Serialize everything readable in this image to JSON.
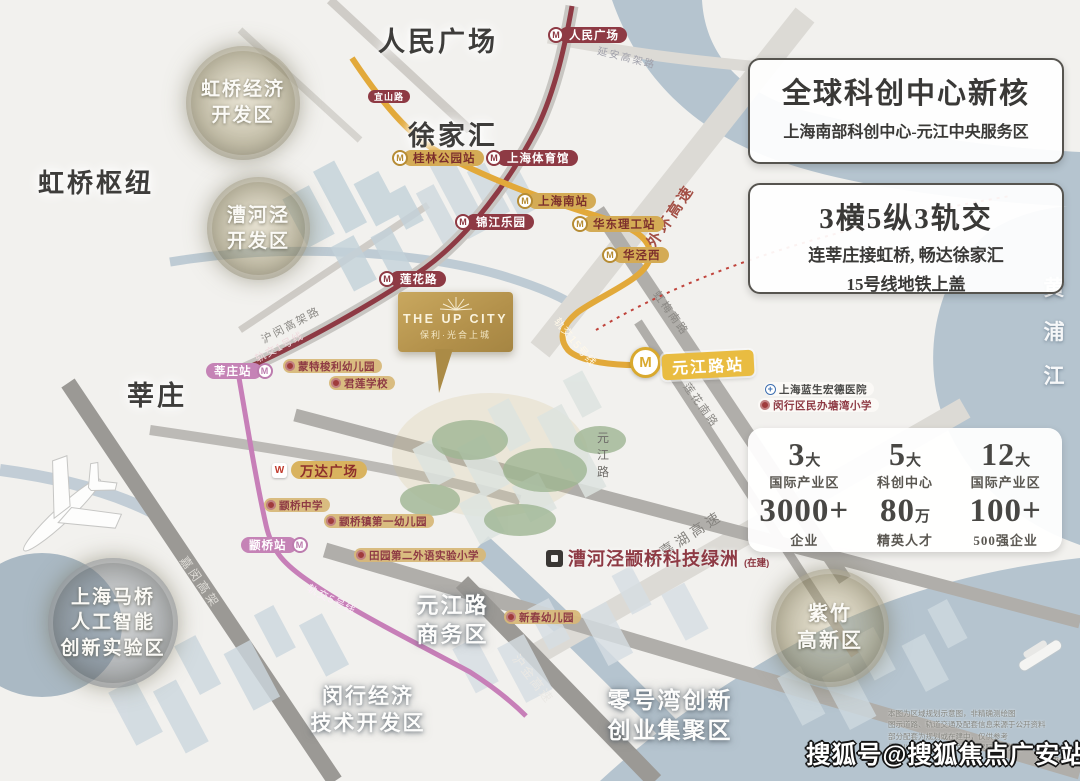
{
  "project": {
    "name_en": "THE UP CITY",
    "name_cn": "保利·光合上城"
  },
  "icons": {
    "metro_logo": "M",
    "wanda_logo": "W",
    "hospital_cross": "+"
  },
  "info_box_1": {
    "title": "全球科创中心新核",
    "subtitle": "上海南部科创中心-元江中央服务区"
  },
  "info_box_2": {
    "title": "3横5纵3轨交",
    "line1": "连莘庄接虹桥, 畅达徐家汇",
    "line2": "15号线地铁上盖"
  },
  "stats": {
    "cells": [
      {
        "num": "3",
        "unit": "大",
        "label": "国际产业区"
      },
      {
        "num": "5",
        "unit": "大",
        "label": "科创中心"
      },
      {
        "num": "12",
        "unit": "大",
        "label": "国际产业区"
      },
      {
        "num": "3000+",
        "unit": "",
        "label": "企业"
      },
      {
        "num": "80",
        "unit": "万",
        "label": "精英人才"
      },
      {
        "num": "100+",
        "unit": "",
        "label": "500强企业"
      }
    ]
  },
  "districts": {
    "hongqiao_edz": {
      "line1": "虹桥经济",
      "line2": "开发区"
    },
    "caohejing": {
      "line1": "漕河泾",
      "line2": "开发区"
    },
    "maqiao": {
      "line1": "上海马桥",
      "line2": "人工智能",
      "line3": "创新实验区"
    },
    "zizhu": {
      "line1": "紫竹",
      "line2": "高新区"
    }
  },
  "areas": {
    "renmin": "人民广场",
    "xujiahui": "徐家汇",
    "hongqiao_hub": "虹桥枢纽",
    "xinzhuang": "莘庄",
    "yuanjiang_biz": {
      "line1": "元江路",
      "line2": "商务区"
    },
    "minhang_dev": {
      "line1": "闵行经济",
      "line2": "技术开发区"
    },
    "lhw": {
      "line1": "零号湾创新",
      "line2": "创业集聚区"
    }
  },
  "stations": {
    "renmin": "人民广场",
    "yishan": "宜山路",
    "shty": "上海体育馆",
    "jjly": "锦江乐园",
    "lianhua": "莲花路",
    "guilin": "桂林公园站",
    "shnz": "上海南站",
    "hdlg": "华东理工站",
    "hjx": "华泾西",
    "yuanjiang": "元江路站",
    "xinzhuang": "莘庄站",
    "zhuanqiao": "颛桥站"
  },
  "pois": {
    "mengte": "蒙特梭利幼儿园",
    "junlian": "君莲学校",
    "wanda": "万达广场",
    "zq_middle": "颛桥中学",
    "zq_kinder": "颛桥镇第一幼儿园",
    "tianyuan": "田园第二外语实验小学",
    "xinchun": "新春幼儿园",
    "hospital": "上海蓝生宏德医院",
    "tangwan": "闵行区民办塘湾小学",
    "oasis": "漕河泾颛桥科技绿洲",
    "oasis_suffix": "(在建)"
  },
  "roads": {
    "yanan": "延安高架路",
    "waihuan": "外环高速",
    "humin": "沪闵高架路",
    "line1": "轨交1号线",
    "line5": "轨交5号线",
    "line15": "轨交15号线",
    "jiamin": "嘉闵高架",
    "shenjiahu": "申嘉湖高速",
    "hujin": "沪金高速",
    "hongmei": "虹梅南路",
    "lianhua_rd": "莲花南路",
    "yuanjiang_rd": "元江路",
    "huangpu": "黄浦江"
  },
  "watermark": "搜狐号@搜狐焦点广安站",
  "fine_print": [
    "本图为区域规划示意图，非精确测绘图",
    "图示道路、轨道交通及配套信息来源于公开资料",
    "部分配套为规划或在建中，仅供参考",
    "最终以政府部门批复文件及实际交付为准",
    "区位示意图"
  ]
}
